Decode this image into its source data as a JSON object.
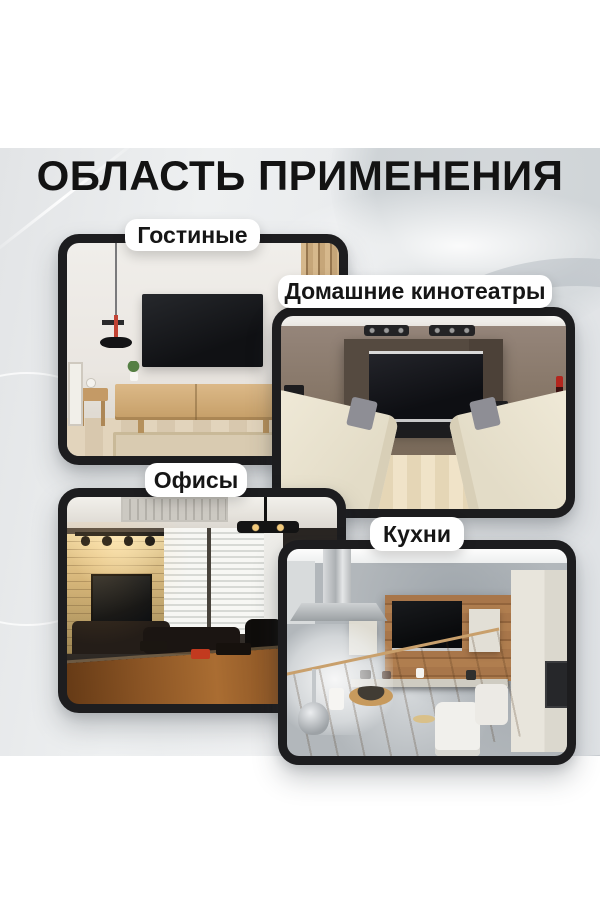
{
  "title": "ОБЛАСТЬ ПРИМЕНЕНИЯ",
  "cards": {
    "living_rooms": {
      "label": "Гостиные",
      "scene": "светлая гостиная с телевизором на стене и деревянной тумбой"
    },
    "home_theaters": {
      "label": "Домашние кинотеатры",
      "scene": "комната домашнего кинотеатра с экраном, колонками и двумя диванами"
    },
    "offices": {
      "label": "Офисы",
      "scene": "офис-переговорная с каменной стеной, телевизором и большим столом"
    },
    "kitchens": {
      "label": "Кухни",
      "scene": "кухня с серыми стенами, деревянной панелью с телевизором и барной стойкой"
    }
  },
  "colors": {
    "page_background": "#ffffff",
    "panel_background": "#e9ebed",
    "card_border": "#1d1d1f",
    "pill_background": "#ffffff",
    "title_text": "#131313",
    "accent_red": "#c24334"
  }
}
